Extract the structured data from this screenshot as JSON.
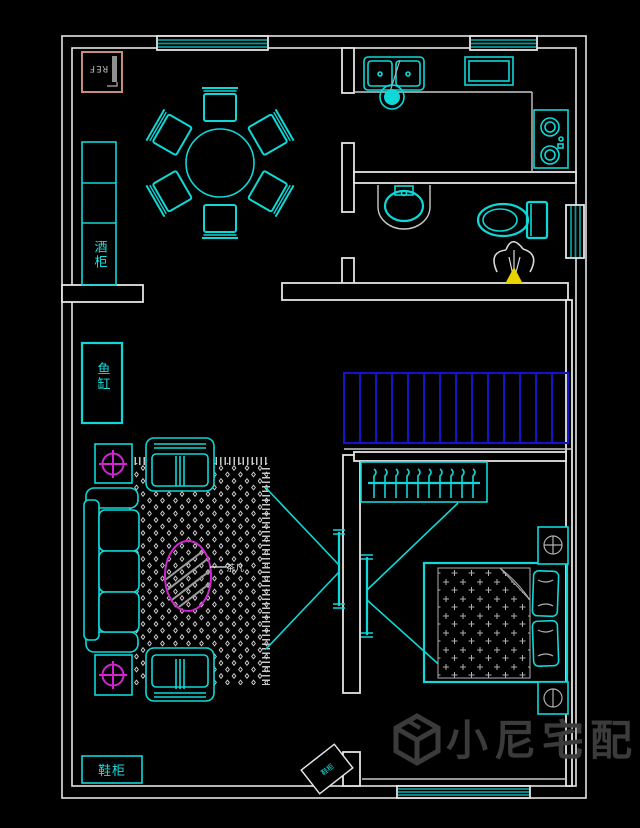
{
  "app": {
    "type": "cad-floor-plan-view",
    "background": "#000000"
  },
  "labels": {
    "fridge": "REF",
    "wine_cabinet": "酒柜",
    "fish_tank": "鱼缸",
    "shoe_cabinet": "鞋柜",
    "entry_box_tag": "鞋柜",
    "coffee_table_tag": "茶几"
  },
  "watermark": {
    "brand": "小尼宅配",
    "logo": "cube-logo"
  },
  "colors": {
    "furniture_cyan": "#0fd8d8",
    "wall_white": "#e4e4e4",
    "stairs_blue": "#1414c8",
    "accent_magenta": "#d026d0",
    "window_teal": "#0e9494",
    "drain_highlight_yellow": "#e8d500",
    "fridge_border_salmon": "#c68d7c",
    "watermark_gray": "#3b3b3b",
    "detail_gray": "#b0b0b0"
  }
}
